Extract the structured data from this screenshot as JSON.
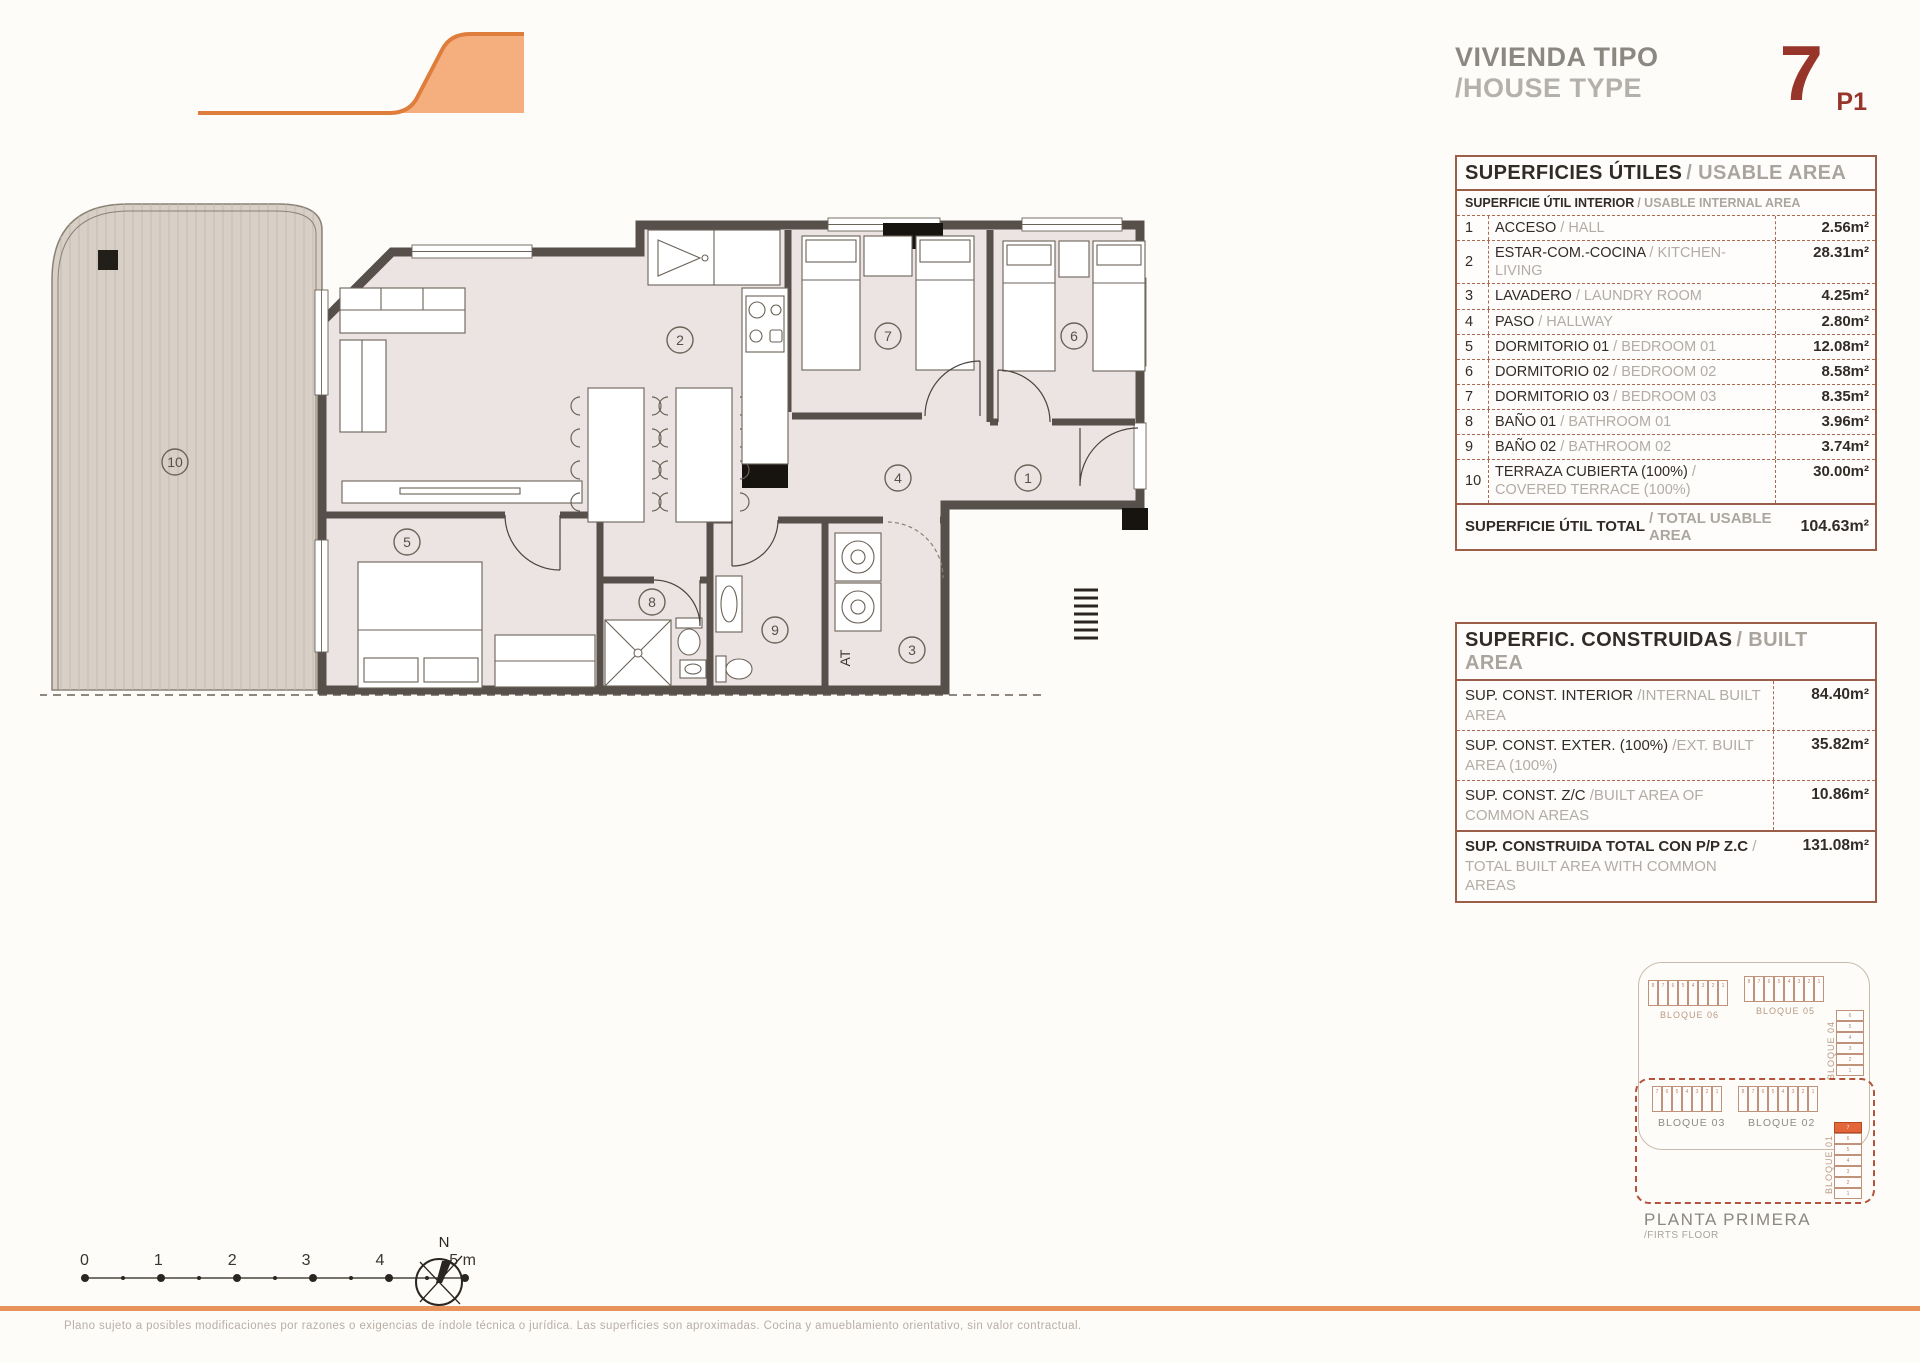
{
  "header": {
    "title_es": "VIVIENDA TIPO",
    "title_en": "/HOUSE TYPE",
    "type_number": "7",
    "type_suffix": "P1"
  },
  "usable_table": {
    "title_es": "SUPERFICIES ÚTILES",
    "title_en": "/ USABLE AREA",
    "subtitle_es": "SUPERFICIE ÚTIL INTERIOR",
    "subtitle_en": "/ USABLE INTERNAL AREA",
    "rows": [
      {
        "num": "1",
        "es": "ACCESO",
        "en": "/ HALL",
        "value": "2.56m²"
      },
      {
        "num": "2",
        "es": "ESTAR-COM.-COCINA",
        "en": "/ KITCHEN-LIVING",
        "value": "28.31m²"
      },
      {
        "num": "3",
        "es": "LAVADERO",
        "en": "/ LAUNDRY ROOM",
        "value": "4.25m²"
      },
      {
        "num": "4",
        "es": "PASO",
        "en": "/ HALLWAY",
        "value": "2.80m²"
      },
      {
        "num": "5",
        "es": "DORMITORIO 01",
        "en": "/ BEDROOM 01",
        "value": "12.08m²"
      },
      {
        "num": "6",
        "es": "DORMITORIO 02",
        "en": "/ BEDROOM 02",
        "value": "8.58m²"
      },
      {
        "num": "7",
        "es": "DORMITORIO 03",
        "en": "/ BEDROOM 03",
        "value": "8.35m²"
      },
      {
        "num": "8",
        "es": "BAÑO 01",
        "en": "/ BATHROOM 01",
        "value": "3.96m²"
      },
      {
        "num": "9",
        "es": "BAÑO 02",
        "en": "/ BATHROOM 02",
        "value": "3.74m²"
      },
      {
        "num": "10",
        "es": "TERRAZA CUBIERTA (100%)",
        "en": "/ COVERED TERRACE (100%)",
        "value": "30.00m²"
      }
    ],
    "total_es": "SUPERFICIE ÚTIL TOTAL",
    "total_en": "/ TOTAL USABLE AREA",
    "total_value": "104.63m²"
  },
  "built_table": {
    "title_es": "SUPERFIC. CONSTRUIDAS",
    "title_en": "/ BUILT AREA",
    "rows": [
      {
        "es": "SUP. CONST. INTERIOR",
        "en": "/INTERNAL BUILT AREA",
        "value": "84.40m²"
      },
      {
        "es": "SUP. CONST. EXTER. (100%)",
        "en": "/EXT. BUILT AREA (100%)",
        "value": "35.82m²"
      },
      {
        "es": "SUP. CONST. Z/C",
        "en": "/BUILT AREA OF COMMON AREAS",
        "value": "10.86m²"
      }
    ],
    "total_es": "SUP. CONSTRUIDA TOTAL CON P/P Z.C",
    "total_en": "/ TOTAL BUILT AREA WITH COMMON AREAS",
    "total_value": "131.08m²"
  },
  "floor_plan": {
    "rooms": {
      "r1": "1",
      "r2": "2",
      "r3": "3",
      "r4": "4",
      "r5": "5",
      "r6": "6",
      "r7": "7",
      "r8": "8",
      "r9": "9",
      "r10": "10"
    },
    "at_label": "AT"
  },
  "scale_bar": {
    "labels": [
      {
        "n": "0"
      },
      {
        "n": "1"
      },
      {
        "n": "2"
      },
      {
        "n": "3"
      },
      {
        "n": "4"
      },
      {
        "n": "5 m"
      }
    ]
  },
  "compass": {
    "north_label": "N"
  },
  "site_plan": {
    "blocks": [
      {
        "name": "BLOQUE 06",
        "units": [
          {
            "n": "8"
          },
          {
            "n": "7"
          },
          {
            "n": "6"
          },
          {
            "n": "5"
          },
          {
            "n": "4"
          },
          {
            "n": "3"
          },
          {
            "n": "2"
          },
          {
            "n": "1"
          }
        ]
      },
      {
        "name": "BLOQUE 05",
        "units": [
          {
            "n": "8"
          },
          {
            "n": "7"
          },
          {
            "n": "6"
          },
          {
            "n": "5"
          },
          {
            "n": "4"
          },
          {
            "n": "3"
          },
          {
            "n": "2"
          },
          {
            "n": "1"
          }
        ]
      },
      {
        "name": "BLOQUE 04",
        "units": [
          {
            "n": "6"
          },
          {
            "n": "5"
          },
          {
            "n": "4"
          },
          {
            "n": "3"
          },
          {
            "n": "2"
          },
          {
            "n": "1"
          }
        ]
      },
      {
        "name": "BLOQUE 03",
        "units": [
          {
            "n": "7"
          },
          {
            "n": "6"
          },
          {
            "n": "5"
          },
          {
            "n": "4"
          },
          {
            "n": "3"
          },
          {
            "n": "2"
          },
          {
            "n": "1"
          }
        ]
      },
      {
        "name": "BLOQUE 02",
        "units": [
          {
            "n": "8"
          },
          {
            "n": "7"
          },
          {
            "n": "6"
          },
          {
            "n": "5"
          },
          {
            "n": "4"
          },
          {
            "n": "3"
          },
          {
            "n": "2"
          },
          {
            "n": "1"
          }
        ]
      },
      {
        "name": "BLOQUE 01",
        "units": [
          {
            "n": "7",
            "hl": true
          },
          {
            "n": "6"
          },
          {
            "n": "5"
          },
          {
            "n": "4"
          },
          {
            "n": "3"
          },
          {
            "n": "2"
          },
          {
            "n": "1"
          }
        ]
      }
    ],
    "caption_es": "PLANTA PRIMERA",
    "caption_en": "/FIRTS FLOOR"
  },
  "footer": {
    "disclaimer": "Plano sujeto a posibles modificaciones por razones o exigencias de índole técnica o jurídica. Las superficies son aproximadas. Cocina y amueblamiento orientativo, sin valor contractual."
  }
}
